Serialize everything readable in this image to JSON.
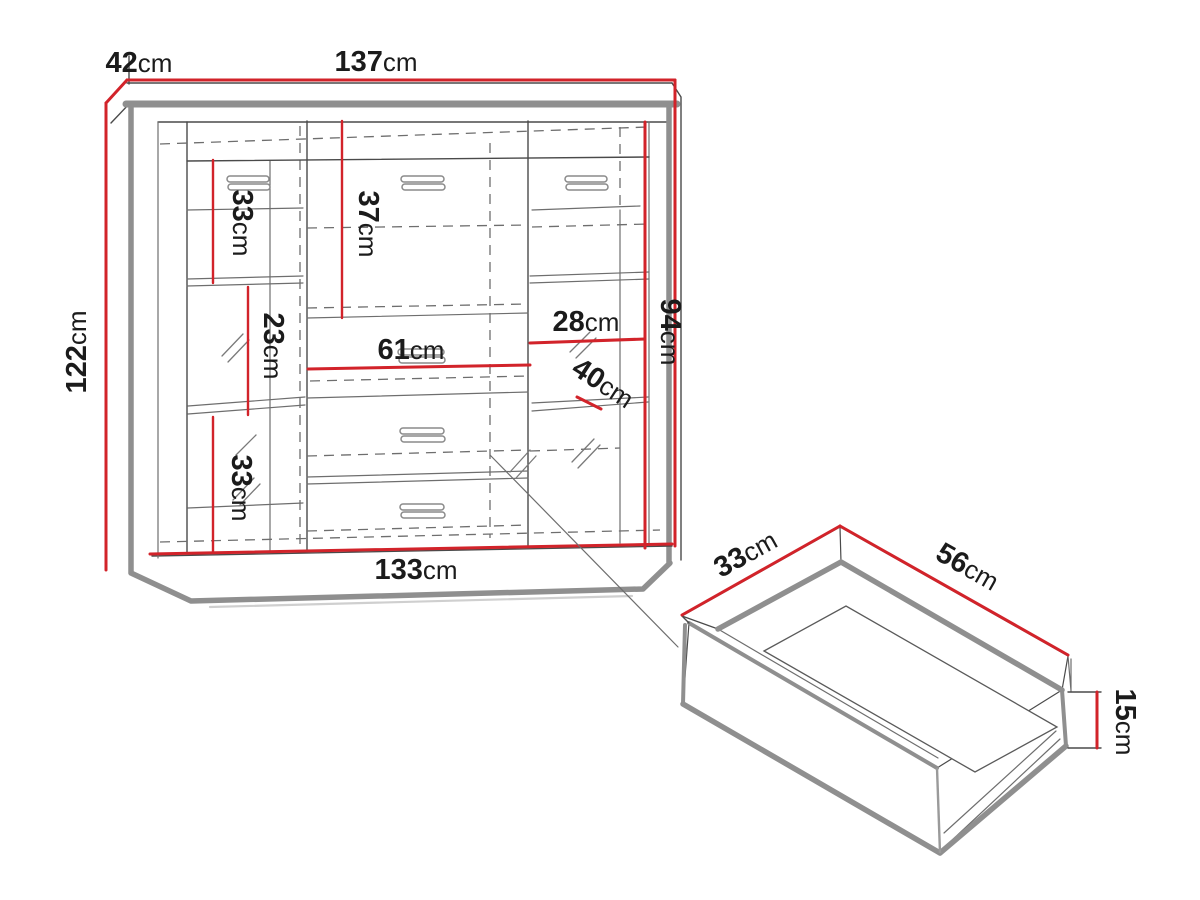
{
  "diagram": {
    "type": "furniture-dimension-drawing",
    "views": [
      "cabinet-front-view",
      "drawer-3d-view"
    ],
    "unit": "cm",
    "colors": {
      "dimension_line": "#d2232a",
      "edge_gray": "#8f8f8f",
      "drawing_line": "#4a4a4a",
      "text": "#1b1b1b",
      "background": "#ffffff"
    }
  },
  "labels": {
    "depth": {
      "value": "42",
      "unit": "cm"
    },
    "width": {
      "value": "137",
      "unit": "cm"
    },
    "height": {
      "value": "122",
      "unit": "cm"
    },
    "left_top": {
      "value": "33",
      "unit": "cm"
    },
    "mid_top": {
      "value": "37",
      "unit": "cm"
    },
    "left_mid": {
      "value": "23",
      "unit": "cm"
    },
    "mid_width": {
      "value": "61",
      "unit": "cm"
    },
    "right_width": {
      "value": "28",
      "unit": "cm"
    },
    "right_height": {
      "value": "94",
      "unit": "cm"
    },
    "right_depth": {
      "value": "40",
      "unit": "cm"
    },
    "left_bottom": {
      "value": "33",
      "unit": "cm"
    },
    "base_width": {
      "value": "133",
      "unit": "cm"
    },
    "drawer_depth": {
      "value": "33",
      "unit": "cm"
    },
    "drawer_width": {
      "value": "56",
      "unit": "cm"
    },
    "drawer_height": {
      "value": "15",
      "unit": "cm"
    }
  }
}
